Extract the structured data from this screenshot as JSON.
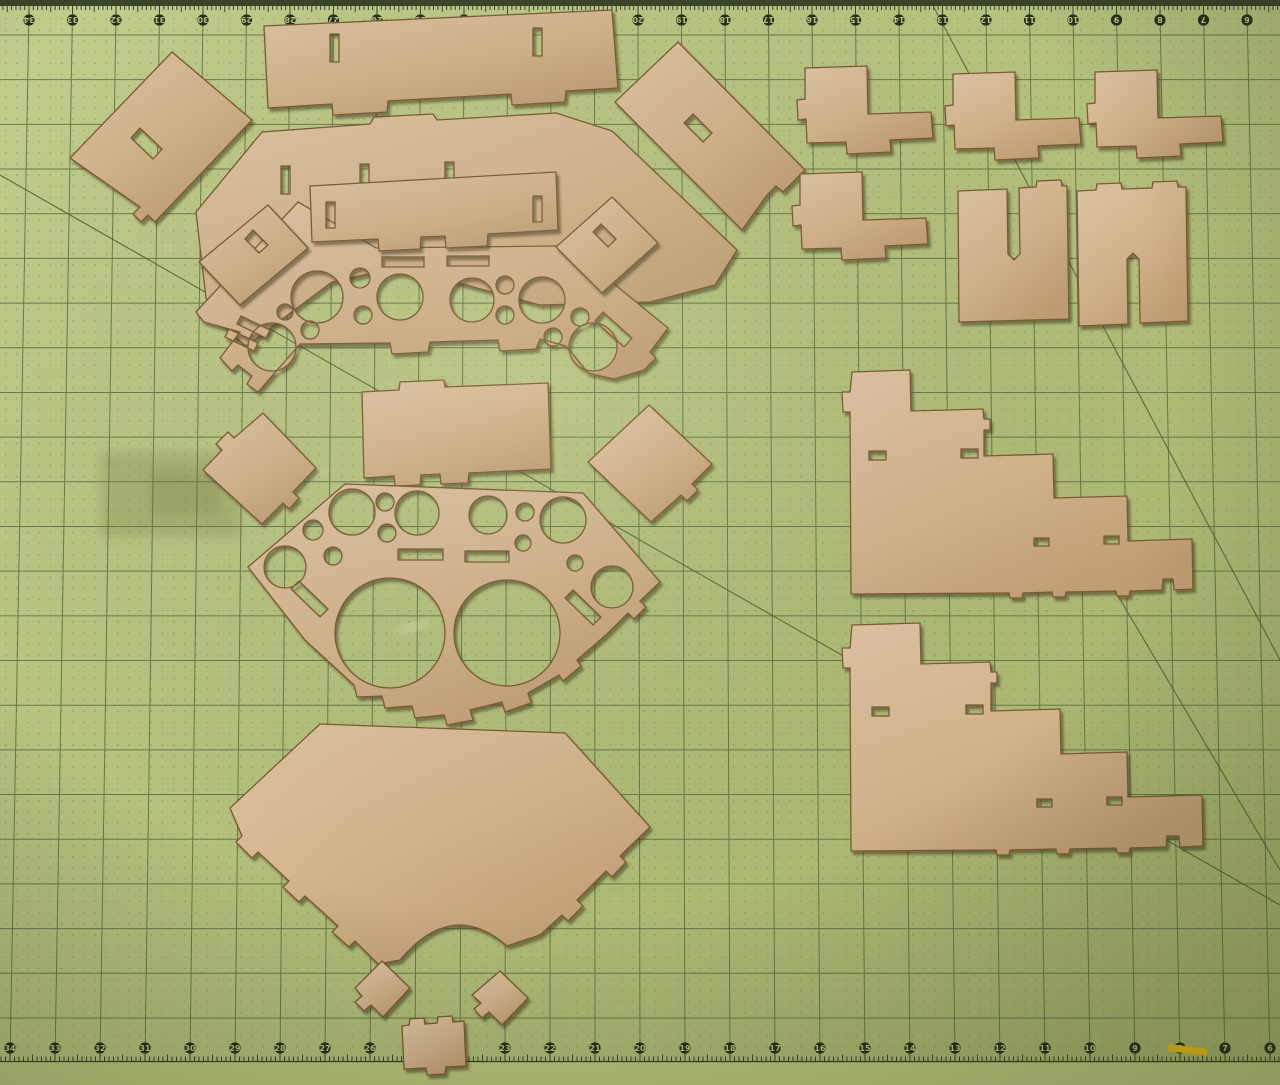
{
  "scene": {
    "description": "Photograph of tan laser-cut MDF model kit parts laid out on a green self-healing cutting mat with numbered inch rulers along the top and bottom edges",
    "subject": "laser-cut wood parts on cutting mat"
  },
  "colors": {
    "mat_light": "#c2ce8c",
    "mat_mid": "#b4c17c",
    "mat_dark": "#a3b069",
    "mat_edge_strip": "#b7c379",
    "grid": "#56663f",
    "dot": "#5d6e44",
    "diagonal": "#4f5f3a",
    "band": "#39452a",
    "ruler_circle": "#272f1c",
    "ruler_text": "#b9c57e",
    "wood_light": "#dfc4a3",
    "wood_mid": "#d2b38c",
    "wood_dark": "#c09d73",
    "wood_edge": "#7c5a31",
    "shadow": "#3e3a1c",
    "yellow_mark": "#e8ba10",
    "smudge": "#6e6e3c",
    "scuff": "#f2eedb"
  },
  "ruler": {
    "numbers_top": [
      34,
      33,
      32,
      31,
      30,
      29,
      28,
      27,
      26,
      25,
      24,
      23,
      22,
      21,
      20,
      19,
      18,
      17,
      16,
      15,
      14,
      13,
      12,
      11,
      10,
      9,
      8,
      7,
      6
    ],
    "numbers_bottom": [
      34,
      33,
      32,
      31,
      30,
      29,
      28,
      27,
      26,
      25,
      24,
      23,
      22,
      21,
      20,
      19,
      18,
      17,
      16,
      15,
      14,
      13,
      12,
      11,
      10,
      9,
      8,
      7,
      6
    ],
    "top_rotated_180": true
  },
  "diagonals": [
    [
      0,
      175,
      1280,
      905
    ],
    [
      930,
      0,
      1280,
      660
    ],
    [
      1085,
      540,
      1280,
      870
    ]
  ],
  "marks": {
    "smudges": [
      {
        "x": 100,
        "y": 452,
        "w": 140,
        "h": 85,
        "opacity": 0.22
      },
      {
        "x": 150,
        "y": 470,
        "w": 70,
        "h": 45,
        "opacity": 0.18
      }
    ],
    "scuffs": [
      {
        "x": 250,
        "y": 297,
        "w": 26,
        "h": 5,
        "rot": -20
      },
      {
        "x": 434,
        "y": 300,
        "w": 24,
        "h": 5,
        "rot": -12
      },
      {
        "x": 398,
        "y": 628,
        "w": 30,
        "h": 6,
        "rot": -15
      },
      {
        "x": 302,
        "y": 472,
        "w": 22,
        "h": 5,
        "rot": -10
      }
    ],
    "yellow_mark": {
      "x": 1168,
      "y": 1044,
      "w": 40,
      "h": 7,
      "rot": 7
    }
  },
  "pieces": [
    {
      "name": "back-angled-panel",
      "d": "M262,132 L370,124 L374,117 L433,114 L437,120 L556,113 L612,131 L737,250 L715,285 L650,302 L540,305 L400,267 L332,282 L246,346 L227,330 L206,298 L196,212 Z M281,166 L290,166 L290,194 L281,194 Z M360,164 L369,164 L369,192 L360,192 Z M445,162 L454,162 L454,190 L445,190 Z"
    },
    {
      "name": "dashboard-panel-upper",
      "d": "M196,312 L298,202 L376,248 L557,246 L576,253 L668,328 L650,352 L656,358 L644,370 L614,379 L588,373 L566,346 L540,339 L536,349 L500,351 L498,340 L430,342 L428,352 L392,354 L390,343 L300,344 L258,392 L247,384 L252,376 L238,365 L232,371 L220,358 L240,332 L204,322 Z M382,257 L424,257 L424,267 L382,267 Z M447,256 L489,256 L489,266 L447,266 Z M603,312 L632,338 L624,347 L595,321 Z M229,329 L258,343 L254,351 L225,337 Z M241,316 L270,330 L266,338 L237,324 Z",
      "holes": [
        [
          317,
          297,
          26
        ],
        [
          360,
          278,
          10
        ],
        [
          400,
          297,
          23
        ],
        [
          363,
          315,
          9
        ],
        [
          285,
          312,
          8
        ],
        [
          310,
          330,
          9
        ],
        [
          272,
          347,
          24
        ],
        [
          472,
          300,
          22
        ],
        [
          505,
          285,
          9
        ],
        [
          542,
          300,
          23
        ],
        [
          505,
          315,
          9
        ],
        [
          553,
          337,
          9
        ],
        [
          580,
          317,
          9
        ],
        [
          593,
          347,
          24
        ]
      ]
    },
    {
      "name": "slotted-strip-left",
      "d": "M268,205 L308,248 L240,305 L199,262 Z M253,230 L268,245 L259,253 L245,239 Z"
    },
    {
      "name": "slotted-strip-right",
      "d": "M612,197 L658,243 L602,293 L556,247 Z M601,224 L616,239 L608,247 L593,232 Z"
    },
    {
      "name": "tilted-rect-left",
      "d": "M172,52 L252,120 L155,222 L148,215 L141,222 L133,214 L140,207 L70,158 Z M140,128 L162,149 L153,159 L131,138 Z"
    },
    {
      "name": "tilted-rect-right",
      "d": "M678,42 L805,170 L783,192 L776,186 L767,195 L742,230 L615,102 Z M693,114 L712,133 L703,142 L684,123 Z"
    },
    {
      "name": "top-rectangle",
      "d": "M264,26 L612,10 L618,88 L566,91 L565,102 L512,105 L511,94 L388,101 L387,112 L333,115 L332,104 L268,108 Z M330,34 L339,34 L339,62 L330,62 Z M533,28 L542,28 L542,56 L533,56 Z"
    },
    {
      "name": "slotted-bar",
      "d": "M310,186 L556,172 L558,230 L488,234 L487,246 L446,248 L445,236 L421,237 L420,249 L379,251 L378,239 L312,242 Z M326,202 L335,202 L335,228 L326,228 Z M533,196 L542,196 L542,222 L533,222 Z"
    },
    {
      "name": "mid-rectangle",
      "d": "M362,392 L399,390 L400,382 L444,380 L445,387 L548,383 L551,469 L469,473 L468,483 L441,484 L440,474 L421,475 L420,485 L395,486 L394,476 L364,478 Z"
    },
    {
      "name": "tilted-square-left",
      "d": "M263,413 L316,468 L293,492 L299,498 L289,509 L283,503 L262,524 L203,470 L222,450 L216,444 L228,432 L234,438 Z"
    },
    {
      "name": "tilted-square-right",
      "d": "M649,405 L712,464 L692,484 L698,490 L687,501 L681,495 L651,522 L588,462 Z"
    },
    {
      "name": "dashboard-panel-lower",
      "d": "M248,567 L345,484 L583,493 L660,582 L640,601 L646,607 L634,619 L628,613 L607,634 L577,660 L581,666 L563,681 L559,675 L528,693 L531,703 L505,712 L502,702 L470,710 L473,720 L447,725 L444,715 L415,718 L412,706 L385,708 L382,696 L357,697 L354,685 L305,640 Z M398,549 L443,549 L443,560 L398,560 Z M465,551 L509,551 L509,562 L465,562 Z M299,581 L328,609 L320,617 L291,589 Z M573,590 L601,617 L593,625 L565,598 Z",
      "holes": [
        [
          352,
          512,
          23
        ],
        [
          385,
          502,
          9
        ],
        [
          417,
          513,
          22
        ],
        [
          387,
          533,
          9
        ],
        [
          313,
          530,
          10
        ],
        [
          333,
          556,
          9
        ],
        [
          285,
          567,
          21
        ],
        [
          488,
          515,
          19
        ],
        [
          525,
          512,
          9
        ],
        [
          563,
          520,
          23
        ],
        [
          523,
          543,
          8
        ],
        [
          575,
          563,
          8
        ],
        [
          612,
          587,
          21
        ],
        [
          390,
          633,
          55
        ],
        [
          507,
          633,
          53
        ]
      ]
    },
    {
      "name": "hull-floor-pentagon",
      "d": "M320,724 L565,733 L650,827 L620,856 L626,862 L612,877 L606,871 L577,900 L583,906 L568,921 L562,915 L540,935 L507,946 Q452,898 400,960 L378,964 L355,941 L349,947 L332,932 L338,926 L305,896 L299,902 L283,887 L289,881 L258,852 L252,858 L236,842 L242,836 L230,808 Z"
    },
    {
      "name": "small-diamond-left",
      "d": "M382,961 L410,988 L383,1017 L371,1005 L364,1011 L355,1002 L362,996 L355,988 Z"
    },
    {
      "name": "small-diamond-right",
      "d": "M500,971 L528,998 L502,1025 L489,1012 L482,1018 L474,1009 L481,1003 L472,995 Z"
    },
    {
      "name": "bottom-tabbed-rect",
      "d": "M402,1026 L409,1025 L410,1019 L424,1018 L425,1024 L437,1023 L438,1017 L452,1016 L453,1022 L464,1021 L466,1066 L446,1067 L445,1074 L427,1075 L426,1068 L404,1069 Z"
    },
    {
      "name": "bracket-l-1",
      "transform": "translate(805,66)",
      "d": "M0,2 L62,0 L63,48 L126,46 L128,72 L85,74 L86,86 L42,88 L41,76 L2,77 L1,53 L-7,54 L-8,34 L0,33 Z"
    },
    {
      "name": "bracket-l-2",
      "transform": "translate(953,72)",
      "d": "M0,2 L62,0 L63,48 L126,46 L128,72 L85,74 L86,86 L42,88 L41,76 L2,77 L1,53 L-7,54 L-8,34 L0,33 Z"
    },
    {
      "name": "bracket-l-3",
      "transform": "translate(1095,70)",
      "d": "M0,2 L62,0 L63,48 L126,46 L128,72 L85,74 L86,86 L42,88 L41,76 L2,77 L1,53 L-7,54 L-8,34 L0,33 Z"
    },
    {
      "name": "bracket-l-4",
      "transform": "translate(800,172)",
      "d": "M0,2 L62,0 L63,48 L126,46 L128,72 L85,74 L86,86 L42,88 L41,76 L2,77 L1,53 L-7,54 L-8,34 L0,33 Z"
    },
    {
      "name": "u-channel-slot-top",
      "d": "M958,191 L1007,189 L1008,254 L1014,260 L1020,254 L1019,188 L1036,187 L1037,181 L1061,180 L1062,186 L1067,186 L1069,319 L959,322 Z"
    },
    {
      "name": "u-channel-slot-bottom",
      "d": "M1077,191 L1096,190 L1097,184 L1121,183 L1122,189 L1152,188 L1153,182 L1177,181 L1178,187 L1186,187 L1188,321 L1140,323 L1139,259 L1133,253 L1127,259 L1128,324 L1079,326 Z"
    },
    {
      "name": "hull-side-upper",
      "d": "M852,372 L910,370 L911,411 L983,409 L984,419 L990,419 L990,430 L984,430 L984,456 L1053,454 L1054,498 L1127,496 L1128,541 L1192,539 L1193,589 L1174,590 L1173,579 L1163,579 L1162,590 L1130,591 L1129,596 L1117,596 L1116,591 L1066,592 L1065,597 L1053,597 L1052,592 L1023,593 L1022,598 L1010,598 L1009,593 L851,594 L850,412 L843,412 L842,392 L850,392 Z M869,451 L886,451 L886,460 L869,460 Z M961,449 L978,449 L978,458 L961,458 Z M1034,538 L1049,538 L1049,546 L1034,546 Z M1104,536 L1119,536 L1119,544 L1104,544 Z"
    },
    {
      "name": "hull-side-lower",
      "d": "M852,625 L920,623 L921,664 L990,662 L991,672 L997,672 L997,683 L991,683 L991,711 L1060,709 L1061,754 L1127,752 L1128,797 L1202,795 L1203,846 L1180,847 L1179,836 L1167,836 L1166,847 L1130,848 L1129,853 L1117,853 L1116,848 L1070,849 L1069,854 L1057,854 L1056,849 L1010,850 L1009,855 L997,855 L996,850 L851,851 L850,668 L843,668 L842,648 L850,648 Z M872,707 L889,707 L889,716 L872,716 Z M966,705 L983,705 L983,714 L966,714 Z M1037,799 L1052,799 L1052,807 L1037,807 Z M1107,797 L1122,797 L1122,805 L1107,805 Z"
    }
  ]
}
